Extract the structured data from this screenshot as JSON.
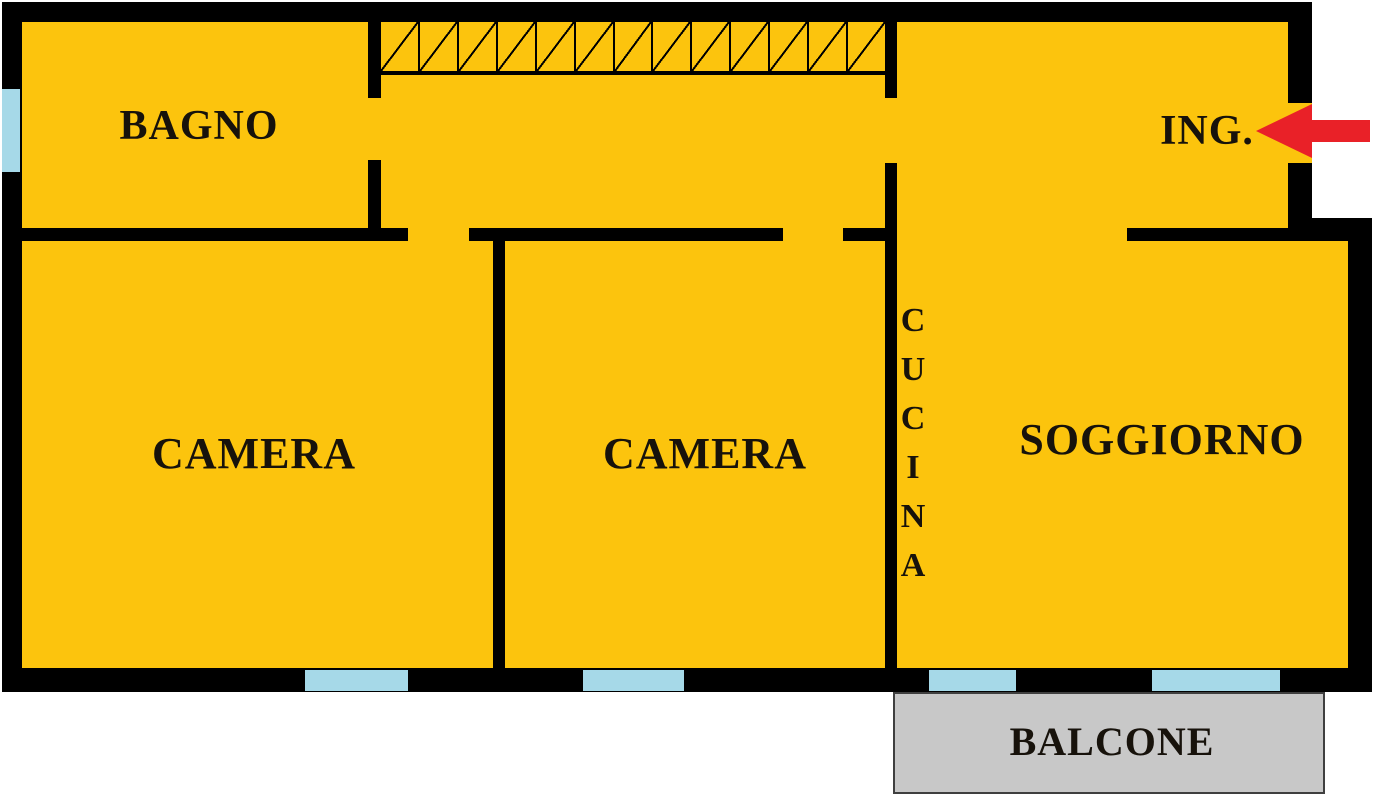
{
  "plan": {
    "rooms": {
      "bagno": {
        "label": "BAGNO"
      },
      "ingresso": {
        "label": "ING."
      },
      "camera_left": {
        "label": "CAMERA"
      },
      "camera_center": {
        "label": "CAMERA"
      },
      "cucina": {
        "label": "CUCINA",
        "letters": [
          "C",
          "U",
          "C",
          "I",
          "N",
          "A"
        ]
      },
      "soggiorno": {
        "label": "SOGGIORNO"
      },
      "balcone": {
        "label": "BALCONE"
      }
    },
    "colors": {
      "room_fill": "#FCC40D",
      "wall": "#000000",
      "window": "#A6D9E8",
      "balcony_fill": "#C8C8C8",
      "balcony_border": "#3F3F3F",
      "entrance_arrow": "#E92128",
      "label_text": "#17120B",
      "background": "#FFFFFF"
    }
  }
}
